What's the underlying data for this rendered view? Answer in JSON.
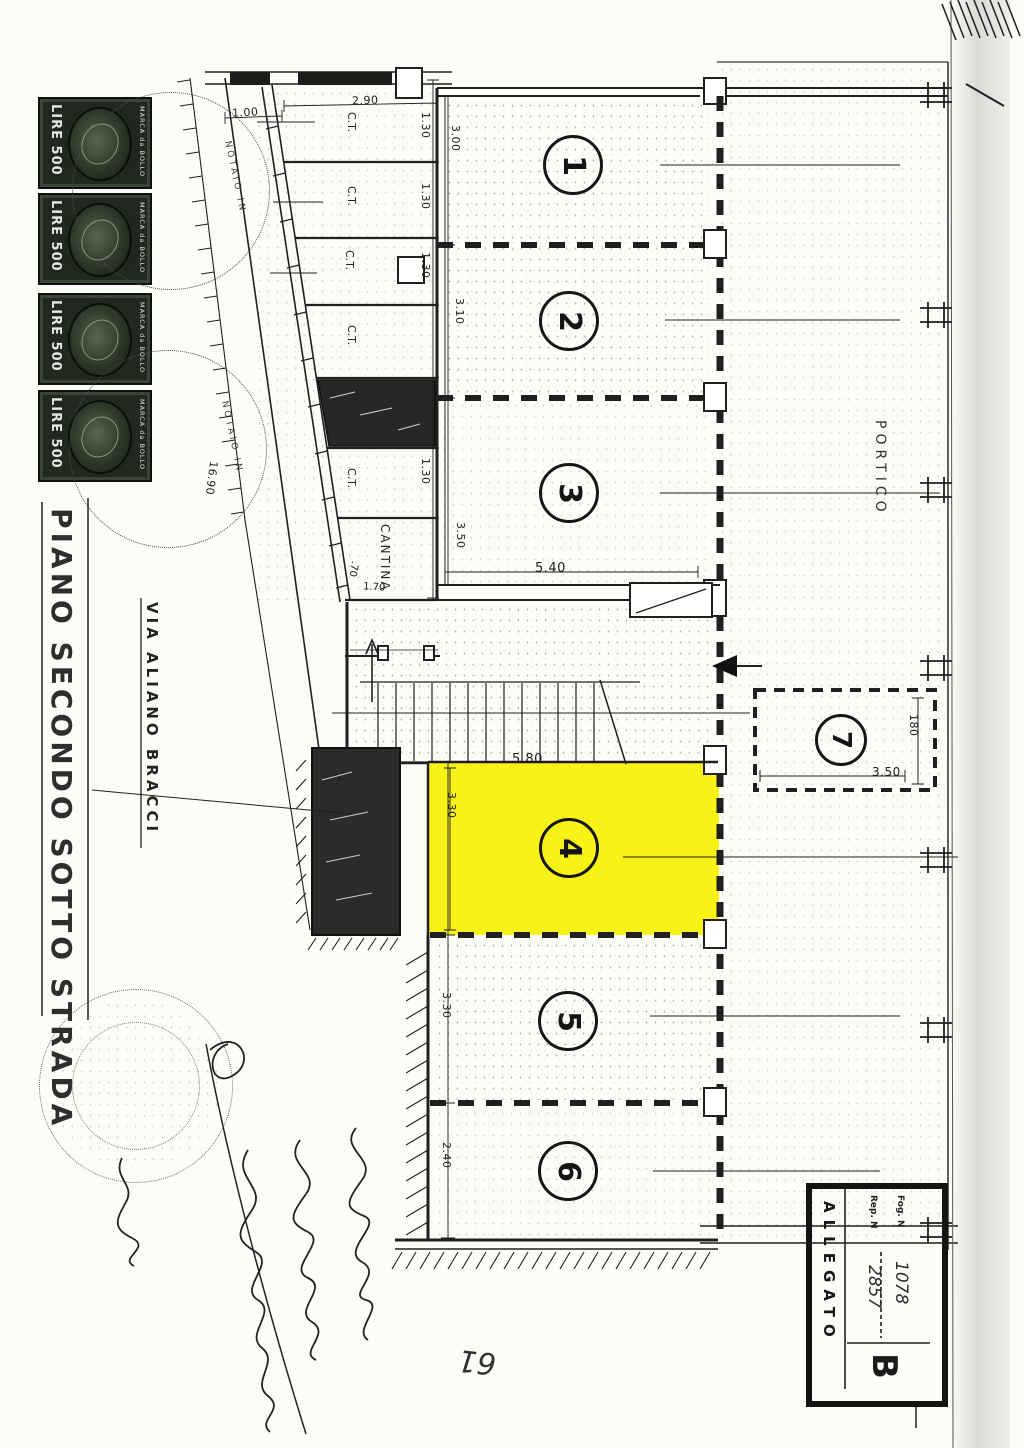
{
  "page": {
    "number": "61"
  },
  "colors": {
    "highlight": "#f8f216",
    "ink": "#1f1f1f",
    "stamp_green": "#20281f",
    "paper": "#fcfcf9"
  },
  "title_block": {
    "floor_title": "PIANO SECONDO SOTTO STRADA"
  },
  "street": {
    "label": "VIA ALIANO BRACCI"
  },
  "revenue_stamp": {
    "value": "LIRE 500",
    "kind": "MARCA da BOLLO"
  },
  "notary_stamp": {
    "arc_text": "NOTAIO IN"
  },
  "plan": {
    "portico_label": "PORTICO",
    "cantina_label": "CANTINA",
    "ct_label": "C.T.",
    "rooms": [
      {
        "number": "1",
        "depth": "3.00"
      },
      {
        "number": "2",
        "depth": "3.10"
      },
      {
        "number": "3",
        "depth": "3.50",
        "width": "5.40"
      },
      {
        "number": "4",
        "depth": "3.30",
        "width": "5.80"
      },
      {
        "number": "5",
        "depth": "3.30"
      },
      {
        "number": "6",
        "depth": "2.40"
      },
      {
        "number": "7",
        "depth": "180",
        "width": "3.50"
      }
    ],
    "strip_dims": {
      "corridor": "1.00",
      "cell_width": "2.90",
      "cells": [
        "1.30",
        "1.30",
        "1.30",
        "1.30"
      ],
      "door": ".70",
      "vestibule": "1.70",
      "slope": "16.90"
    }
  },
  "allegato_stamp": {
    "side_label": "ALLEGATO",
    "field1_label": "Fog. N",
    "field2_label": "Rep. N",
    "value1": "1078",
    "value2": "2857",
    "letter": "B"
  }
}
